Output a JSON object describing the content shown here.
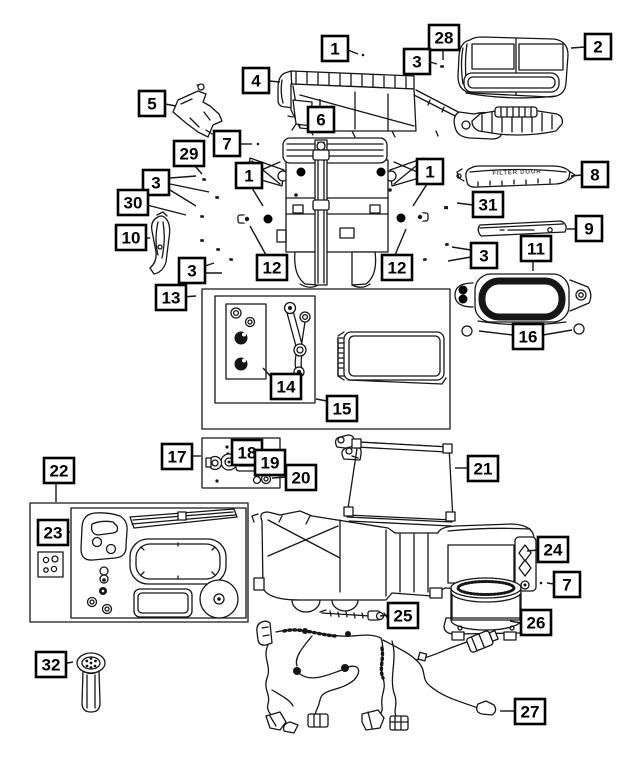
{
  "diagram": {
    "colors": {
      "background": "#ffffff",
      "line": "#161616",
      "callout_fill": "#ffffff",
      "callout_border": "#000000"
    },
    "stamped_text": {
      "filter_door_label": "FILTER DOOR"
    },
    "callouts": [
      {
        "label": "1",
        "x": 322,
        "y": 36,
        "leaders": [
          [
            348,
            50,
            358,
            54
          ]
        ]
      },
      {
        "label": "28",
        "x": 429,
        "y": 25,
        "leaders": [
          [
            443,
            50,
            443,
            60
          ]
        ]
      },
      {
        "label": "3",
        "x": 404,
        "y": 49,
        "leaders": [
          [
            430,
            62,
            437,
            64
          ]
        ]
      },
      {
        "label": "2",
        "x": 585,
        "y": 34,
        "leaders": [
          [
            585,
            47,
            571,
            48
          ]
        ]
      },
      {
        "label": "4",
        "x": 243,
        "y": 68,
        "leaders": [
          [
            269,
            81,
            280,
            82
          ]
        ]
      },
      {
        "label": "5",
        "x": 139,
        "y": 91,
        "leaders": [
          [
            165,
            104,
            176,
            106
          ]
        ]
      },
      {
        "label": "6",
        "x": 308,
        "y": 107,
        "leaders": [
          [
            320,
            107,
            320,
            99
          ]
        ]
      },
      {
        "label": "7",
        "x": 214,
        "y": 131,
        "leaders": [
          [
            240,
            144,
            252,
            144
          ]
        ]
      },
      {
        "label": "29",
        "x": 174,
        "y": 141,
        "leaders": [
          [
            195,
            166,
            202,
            174
          ]
        ]
      },
      {
        "label": "3",
        "x": 143,
        "y": 170,
        "leaders": [
          [
            170,
            178,
            196,
            176
          ],
          [
            170,
            184,
            209,
            192
          ],
          [
            170,
            190,
            196,
            206
          ]
        ]
      },
      {
        "label": "30",
        "x": 118,
        "y": 190,
        "leaders": [
          [
            143,
            204,
            186,
            215
          ]
        ]
      },
      {
        "label": "1",
        "x": 236,
        "y": 163,
        "leaders": [
          [
            252,
            188,
            263,
            206
          ]
        ]
      },
      {
        "label": "1",
        "x": 417,
        "y": 159,
        "leaders": [
          [
            427,
            184,
            413,
            206
          ]
        ]
      },
      {
        "label": "31",
        "x": 473,
        "y": 192,
        "leaders": [
          [
            473,
            205,
            457,
            203
          ]
        ]
      },
      {
        "label": "8",
        "x": 582,
        "y": 162,
        "leaders": [
          [
            582,
            175,
            571,
            176
          ]
        ]
      },
      {
        "label": "9",
        "x": 576,
        "y": 216,
        "leaders": [
          [
            576,
            229,
            567,
            229
          ]
        ]
      },
      {
        "label": "10",
        "x": 116,
        "y": 225,
        "leaders": [
          [
            142,
            238,
            150,
            238
          ]
        ]
      },
      {
        "label": "3",
        "x": 179,
        "y": 258,
        "leaders": [
          [
            205,
            266,
            214,
            263
          ],
          [
            205,
            273,
            222,
            273
          ]
        ]
      },
      {
        "label": "3",
        "x": 471,
        "y": 243,
        "leaders": [
          [
            471,
            250,
            452,
            247
          ],
          [
            471,
            257,
            448,
            261
          ]
        ]
      },
      {
        "label": "11",
        "x": 521,
        "y": 236,
        "leaders": [
          [
            533,
            261,
            533,
            271
          ]
        ]
      },
      {
        "label": "12",
        "x": 257,
        "y": 255,
        "leaders": [
          [
            266,
            255,
            250,
            226
          ]
        ]
      },
      {
        "label": "12",
        "x": 382,
        "y": 255,
        "leaders": [
          [
            395,
            255,
            406,
            229
          ]
        ]
      },
      {
        "label": "13",
        "x": 156,
        "y": 285,
        "leaders": [
          [
            182,
            297,
            196,
            296
          ]
        ]
      },
      {
        "label": "14",
        "x": 271,
        "y": 374,
        "leaders": [
          [
            272,
            378,
            263,
            368
          ]
        ]
      },
      {
        "label": "15",
        "x": 327,
        "y": 396,
        "leaders": [
          [
            327,
            401,
            316,
            399
          ]
        ]
      },
      {
        "label": "16",
        "x": 513,
        "y": 324,
        "leaders": [
          [
            513,
            335,
            479,
            331
          ],
          [
            543,
            335,
            572,
            330
          ]
        ]
      },
      {
        "label": "17",
        "x": 162,
        "y": 444,
        "leaders": [
          [
            188,
            456,
            201,
            456
          ]
        ]
      },
      {
        "label": "18",
        "x": 232,
        "y": 440,
        "leaders": []
      },
      {
        "label": "19",
        "x": 255,
        "y": 450,
        "leaders": []
      },
      {
        "label": "20",
        "x": 286,
        "y": 465,
        "leaders": [
          [
            286,
            477,
            272,
            478
          ]
        ]
      },
      {
        "label": "21",
        "x": 468,
        "y": 456,
        "leaders": [
          [
            468,
            468,
            455,
            468
          ]
        ]
      },
      {
        "label": "22",
        "x": 44,
        "y": 458,
        "leaders": [
          [
            56,
            483,
            56,
            502
          ]
        ]
      },
      {
        "label": "23",
        "x": 38,
        "y": 520,
        "leaders": [
          [
            64,
            532,
            70,
            532
          ]
        ]
      },
      {
        "label": "24",
        "x": 538,
        "y": 537,
        "leaders": [
          [
            538,
            550,
            527,
            551
          ]
        ]
      },
      {
        "label": "7",
        "x": 554,
        "y": 572,
        "leaders": [
          [
            554,
            584,
            547,
            583
          ]
        ]
      },
      {
        "label": "25",
        "x": 388,
        "y": 603,
        "leaders": [
          [
            388,
            615,
            380,
            616
          ]
        ]
      },
      {
        "label": "26",
        "x": 521,
        "y": 610,
        "leaders": [
          [
            521,
            623,
            510,
            621
          ]
        ]
      },
      {
        "label": "27",
        "x": 515,
        "y": 699,
        "leaders": [
          [
            515,
            711,
            500,
            711
          ]
        ]
      },
      {
        "label": "32",
        "x": 36,
        "y": 652,
        "leaders": [
          [
            62,
            664,
            73,
            662
          ]
        ]
      }
    ]
  }
}
